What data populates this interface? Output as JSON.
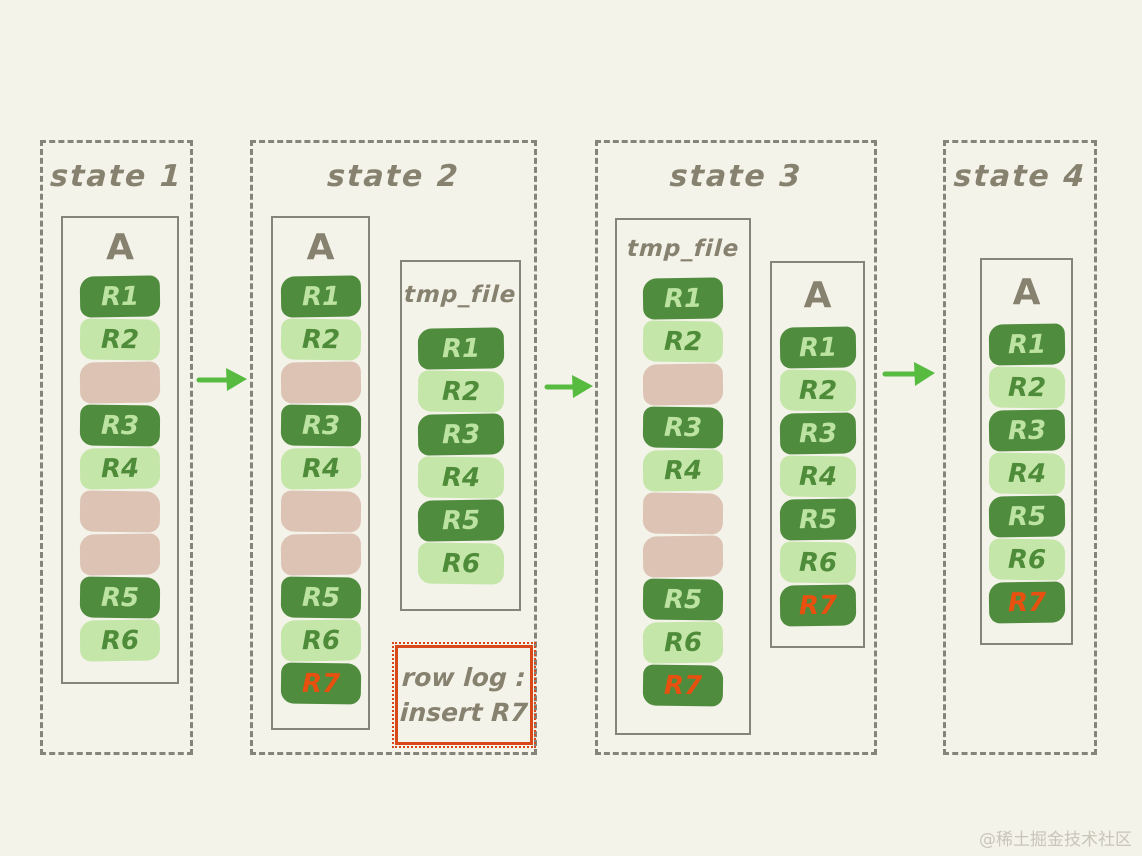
{
  "colors": {
    "background": "#f4f3ea",
    "border": "#85847a",
    "title_text": "#87826f",
    "dark_row": "#4f8c3d",
    "dark_row_text": "#bce3a1",
    "light_row": "#c5e6a9",
    "light_row_text": "#4e8c3a",
    "gap_row": "#dcc3b4",
    "highlight_text": "#e8500f",
    "arrow": "#57bb40",
    "row_log_border": "#d8481b",
    "watermark_color": "#c8c5b9"
  },
  "states": [
    {
      "title": "state 1",
      "files": [
        {
          "label": "A",
          "rows": [
            {
              "text": "R1",
              "variant": "dark"
            },
            {
              "text": "R2",
              "variant": "light"
            },
            {
              "text": "",
              "variant": "gap"
            },
            {
              "text": "R3",
              "variant": "dark"
            },
            {
              "text": "R4",
              "variant": "light"
            },
            {
              "text": "",
              "variant": "gap"
            },
            {
              "text": "",
              "variant": "gap"
            },
            {
              "text": "R5",
              "variant": "dark"
            },
            {
              "text": "R6",
              "variant": "light"
            }
          ]
        }
      ]
    },
    {
      "title": "state 2",
      "files": [
        {
          "label": "A",
          "rows": [
            {
              "text": "R1",
              "variant": "dark"
            },
            {
              "text": "R2",
              "variant": "light"
            },
            {
              "text": "",
              "variant": "gap"
            },
            {
              "text": "R3",
              "variant": "dark"
            },
            {
              "text": "R4",
              "variant": "light"
            },
            {
              "text": "",
              "variant": "gap"
            },
            {
              "text": "",
              "variant": "gap"
            },
            {
              "text": "R5",
              "variant": "dark"
            },
            {
              "text": "R6",
              "variant": "light"
            },
            {
              "text": "R7",
              "variant": "highlight"
            }
          ]
        },
        {
          "label": "tmp_file",
          "rows": [
            {
              "text": "R1",
              "variant": "dark"
            },
            {
              "text": "R2",
              "variant": "light"
            },
            {
              "text": "R3",
              "variant": "dark"
            },
            {
              "text": "R4",
              "variant": "light"
            },
            {
              "text": "R5",
              "variant": "dark"
            },
            {
              "text": "R6",
              "variant": "light"
            }
          ]
        }
      ],
      "row_log": {
        "line1": "row log :",
        "line2": "insert R7"
      }
    },
    {
      "title": "state 3",
      "files": [
        {
          "label": "tmp_file",
          "rows": [
            {
              "text": "R1",
              "variant": "dark"
            },
            {
              "text": "R2",
              "variant": "light"
            },
            {
              "text": "",
              "variant": "gap"
            },
            {
              "text": "R3",
              "variant": "dark"
            },
            {
              "text": "R4",
              "variant": "light"
            },
            {
              "text": "",
              "variant": "gap"
            },
            {
              "text": "",
              "variant": "gap"
            },
            {
              "text": "R5",
              "variant": "dark"
            },
            {
              "text": "R6",
              "variant": "light"
            },
            {
              "text": "R7",
              "variant": "highlight"
            }
          ]
        },
        {
          "label": "A",
          "rows": [
            {
              "text": "R1",
              "variant": "dark"
            },
            {
              "text": "R2",
              "variant": "light"
            },
            {
              "text": "R3",
              "variant": "dark"
            },
            {
              "text": "R4",
              "variant": "light"
            },
            {
              "text": "R5",
              "variant": "dark"
            },
            {
              "text": "R6",
              "variant": "light"
            },
            {
              "text": "R7",
              "variant": "highlight"
            }
          ]
        }
      ]
    },
    {
      "title": "state 4",
      "files": [
        {
          "label": "A",
          "rows": [
            {
              "text": "R1",
              "variant": "dark"
            },
            {
              "text": "R2",
              "variant": "light"
            },
            {
              "text": "R3",
              "variant": "dark"
            },
            {
              "text": "R4",
              "variant": "light"
            },
            {
              "text": "R5",
              "variant": "dark"
            },
            {
              "text": "R6",
              "variant": "light"
            },
            {
              "text": "R7",
              "variant": "highlight"
            }
          ]
        }
      ]
    }
  ],
  "arrows": [
    {
      "name": "state1-to-state2"
    },
    {
      "name": "state2-to-state3"
    },
    {
      "name": "state3-to-state4"
    }
  ],
  "watermark": "@稀土掘金技术社区"
}
